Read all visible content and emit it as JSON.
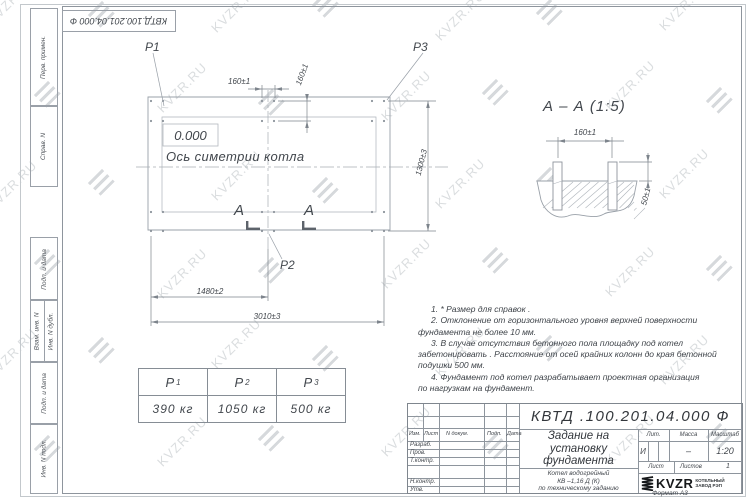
{
  "watermark": {
    "text": "KVZR.RU"
  },
  "top_stamp": {
    "designation": "КВТД.100.201.04.000  Ф"
  },
  "margin_fields": {
    "perv": "Перв. примен.",
    "sprav": "Справ. N",
    "podp1": "Подп. и дата",
    "vzam": "Взам. инв. N",
    "dubl": "Инв. N дубл.",
    "podp2": "Подп. и дата",
    "podl": "Инв. N подл."
  },
  "plan": {
    "p1": "P1",
    "p2": "P2",
    "p3": "P3",
    "level": "0.000",
    "axis": "Ось симетрии котла",
    "dim_160_top": "160±1",
    "dim_160_side": "160±1",
    "dim_1300": "1300±3",
    "dim_1480": "1480±2",
    "dim_3010": "3010±3",
    "section_a_left": "А",
    "section_a_right": "А"
  },
  "section": {
    "title": "А – А  (1:5)",
    "dim_160": "160±1",
    "dim_50": "50±1"
  },
  "notes": {
    "lines": [
      "1.  * Размер для справок .",
      "2.  Отклонение от горизонтального уровня верхней поверхности",
      "фундамента не более 10 мм.",
      "3.  В случае отсутствия бетонного пола площадку под котел",
      "забетонировать . Расстояние от осей крайних колонн до края бетонной",
      "подушки 500 мм.",
      "4.  Фундамент под котел разрабатывает проектная организация",
      "по нагрузкам на фундамент."
    ]
  },
  "load_table": {
    "col1": {
      "base": "P",
      "sub": "1",
      "value": "390 кг"
    },
    "col2": {
      "base": "P",
      "sub": "2",
      "value": "1050 кг"
    },
    "col3": {
      "base": "P",
      "sub": "3",
      "value": "500 кг"
    }
  },
  "title_block": {
    "designation": "КВТД .100.201.04.000  Ф",
    "title_line1": "Задание на",
    "title_line2": "установку",
    "title_line3": "фундамента",
    "product_line1": "Котел водогрейный",
    "product_line2": "КВ –1,16 Д  (К)",
    "product_line3": "по техническому заданию",
    "col_izm": "Изм.",
    "col_list": "Лист",
    "col_doc": "N докум.",
    "col_podp": "Подп.",
    "col_data": "Дата",
    "row_razrab": "Разраб.",
    "row_prov": "Пров.",
    "row_tkontr": "Т.контр.",
    "row_nkontr": "Н.контр.",
    "row_utv": "Утв.",
    "lit_label": "Лит.",
    "mass_label": "Масса",
    "scale_label": "Масштаб",
    "lit_value": "И",
    "mass_value": "–",
    "scale_value": "1:20",
    "sheet_label": "Лист",
    "sheets_label": "Листов",
    "sheets_value": "1",
    "logo_text": "KVZR",
    "logo_sub1": "КОТЕЛЬНЫЙ",
    "logo_sub2": "ЗАВОД РЭП",
    "format": "Формат А3"
  }
}
